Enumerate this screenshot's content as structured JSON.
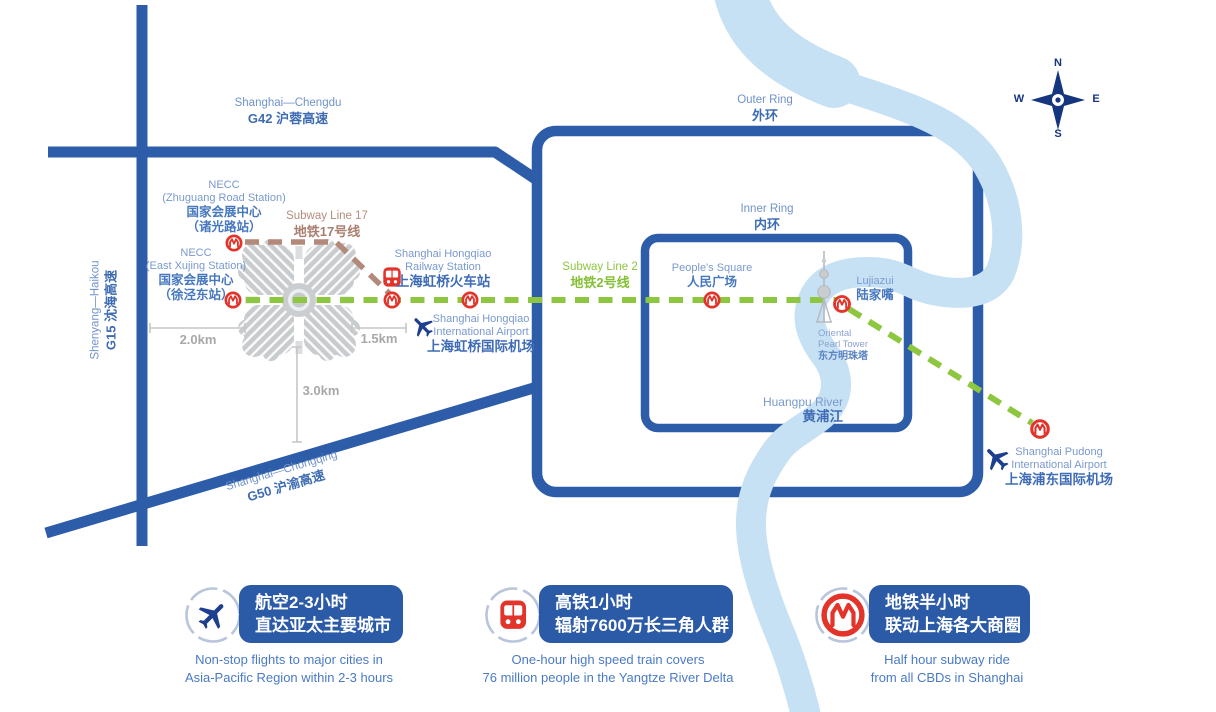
{
  "title": "NECC Shanghai location and transportation infographic map",
  "map": {
    "roads": {
      "g42": {
        "en": "Shanghai—Chengdu",
        "zh": "G42 沪蓉高速"
      },
      "g15": {
        "en": "Shenyang—Haikou",
        "zh": "G15 沈海高速"
      },
      "g50": {
        "en": "Shanghai—Chongqing",
        "zh": "G50 沪渝高速"
      },
      "outer_ring": {
        "en": "Outer Ring",
        "zh": "外环"
      },
      "inner_ring": {
        "en": "Inner Ring",
        "zh": "内环"
      }
    },
    "subway_lines": {
      "line17": {
        "en": "Subway Line 17",
        "zh": "地铁17号线",
        "color": "#b2897b"
      },
      "line2": {
        "en": "Subway Line 2",
        "zh": "地铁2号线",
        "color": "#8dc63f"
      }
    },
    "places": {
      "necc_zhuguang": {
        "en1": "NECC",
        "en2": "(Zhuguang Road Station)",
        "zh1": "国家会展中心",
        "zh2": "（诸光路站）"
      },
      "necc_xujing": {
        "en1": "NECC",
        "en2": "(East Xujing Station)",
        "zh1": "国家会展中心",
        "zh2": "（徐泾东站）"
      },
      "hongqiao_railway": {
        "en1": "Shanghai Hongqiao",
        "en2": "Railway Station",
        "zh": "上海虹桥火车站"
      },
      "hongqiao_airport": {
        "en1": "Shanghai Hongqiao",
        "en2": "International Airport",
        "zh": "上海虹桥国际机场"
      },
      "peoples_square": {
        "en": "People's Square",
        "zh": "人民广场"
      },
      "lujiazui": {
        "en": "Lujiazui",
        "zh": "陆家嘴"
      },
      "oriental_pearl": {
        "en1": "Oriental",
        "en2": "Pearl Tower",
        "zh": "东方明珠塔"
      },
      "huangpu_river": {
        "en": "Huangpu River",
        "zh": "黄浦江"
      },
      "pudong_airport": {
        "en1": "Shanghai Pudong",
        "en2": "International Airport",
        "zh": "上海浦东国际机场"
      }
    },
    "distances": {
      "necc_to_g15": "2.0km",
      "necc_to_hongqiao": "1.5km",
      "necc_to_g50": "3.0km"
    },
    "compass": {
      "n": "N",
      "e": "E",
      "s": "S",
      "w": "W"
    }
  },
  "badges": [
    {
      "icon": "plane-icon",
      "zh1": "航空2-3小时",
      "zh2": "直达亚太主要城市",
      "en1": "Non-stop flights to major cities in",
      "en2": "Asia-Pacific Region within 2-3 hours"
    },
    {
      "icon": "train-icon",
      "zh1": "高铁1小时",
      "zh2": "辐射7600万长三角人群",
      "en1": "One-hour high speed train covers",
      "en2": "76 million people in the Yangtze River Delta"
    },
    {
      "icon": "metro-icon",
      "zh1": "地铁半小时",
      "zh2": "联动上海各大商圈",
      "en1": "Half hour subway ride",
      "en2": "from all CBDs in Shanghai"
    }
  ],
  "colors": {
    "road_blue": "#2d5ca8",
    "river_blue": "#c7e1f4",
    "line2_green": "#8dc63f",
    "line17_tan": "#b2897b",
    "metro_red": "#e3342b",
    "badge_blue": "#2b5aa7",
    "label_blue_en": "#7a99ce",
    "label_blue_zh": "#4678bf"
  }
}
